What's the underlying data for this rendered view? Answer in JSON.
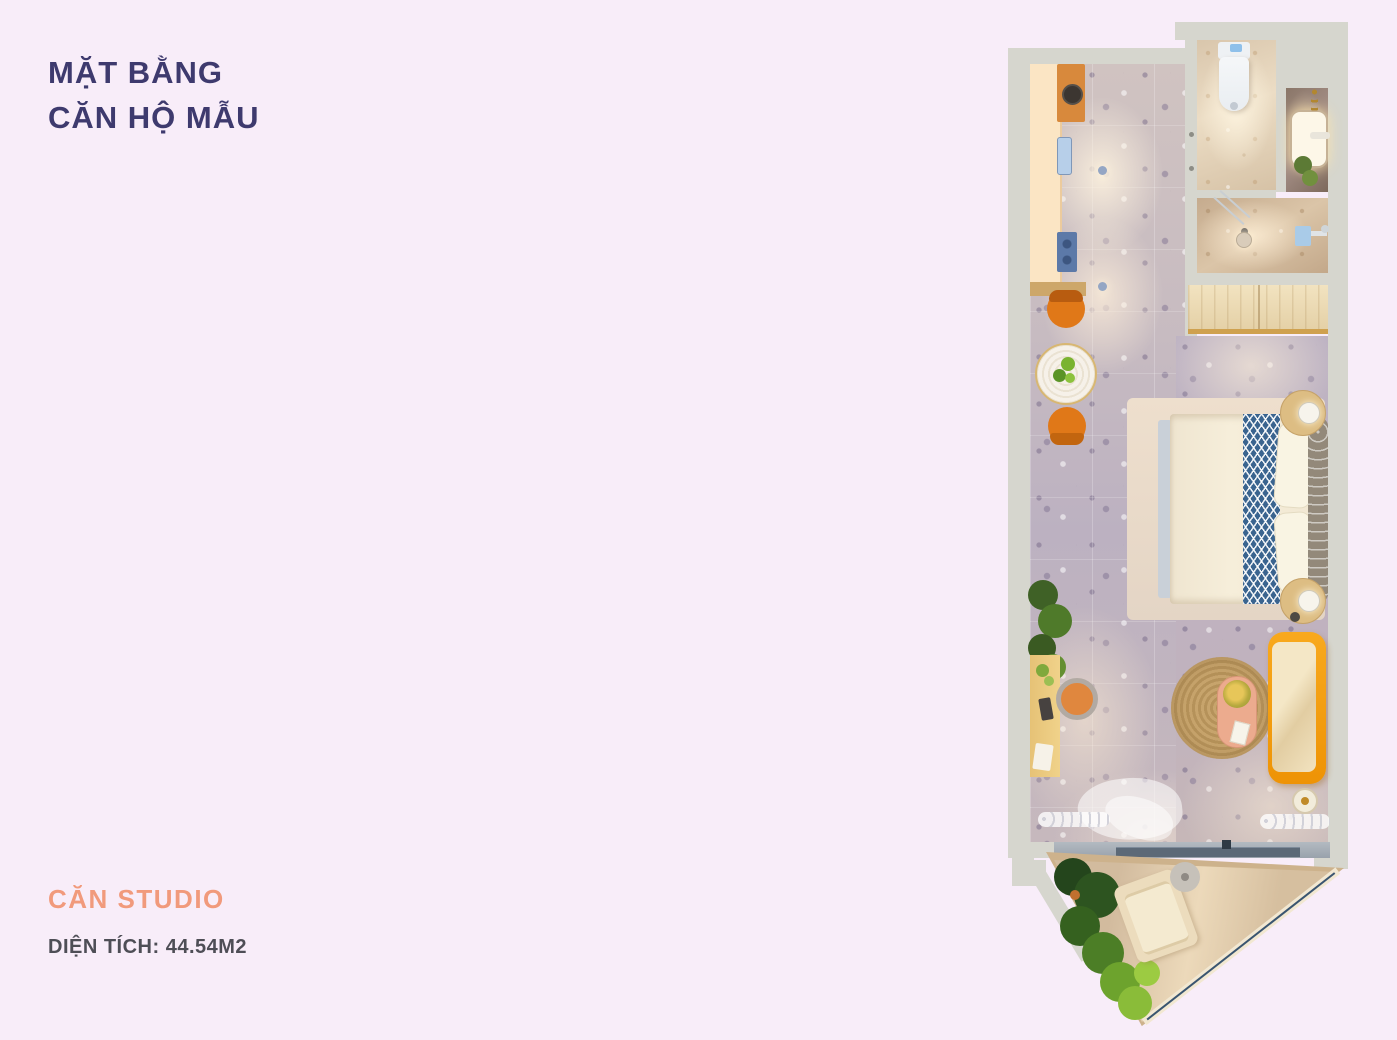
{
  "page": {
    "background_color": "#f8edf9"
  },
  "title": {
    "line1": "MẶT BẰNG",
    "line2": "CĂN HỘ MẪU",
    "color": "#3e3a6e"
  },
  "unit": {
    "type": "CĂN STUDIO",
    "type_color": "#f19a7c",
    "area": "DIỆN TÍCH: 44.54M2",
    "area_color": "#4e4e56"
  },
  "floorplan": {
    "kind": "studio apartment top-down 3D render",
    "rooms": [
      "kitchen",
      "bathroom",
      "shower",
      "wardrobe",
      "bedroom-living",
      "balcony"
    ],
    "palette": {
      "wall": "#d6d6ce",
      "floor_terrazzo": "#c3b7bd",
      "bathroom_floor": "#e3d2bb",
      "kitchen_counter": "#fbe5c4",
      "sofa_orange": "#f59d13",
      "bed_runner_blue": "#3a648f",
      "jute_rug": "#c29e66",
      "balcony_wood": "#dcc5a8",
      "plant_green": "#4c7e26"
    }
  }
}
